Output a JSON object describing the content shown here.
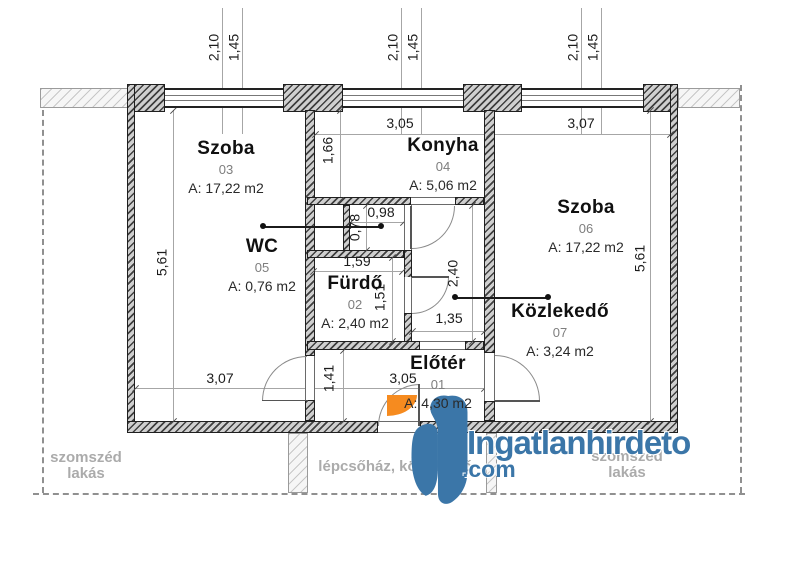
{
  "rooms": {
    "szoba03": {
      "name": "Szoba",
      "num": "03",
      "area": "A: 17,22 m2"
    },
    "konyha": {
      "name": "Konyha",
      "num": "04",
      "area": "A: 5,06 m2"
    },
    "wc": {
      "name": "WC",
      "num": "05",
      "area": "A: 0,76 m2"
    },
    "furdo": {
      "name": "Fürdő",
      "num": "02",
      "area": "A: 2,40 m2"
    },
    "eloter": {
      "name": "Előtér",
      "num": "01",
      "area": "A: 4,30 m2"
    },
    "szoba06": {
      "name": "Szoba",
      "num": "06",
      "area": "A: 17,22 m2"
    },
    "kozlekedo": {
      "name": "Közlekedő",
      "num": "07",
      "area": "A: 3,24 m2"
    }
  },
  "dimensions": {
    "w210": "2,10",
    "w145": "1,45",
    "d305": "3,05",
    "d307": "3,07",
    "d166": "1,66",
    "d561": "5,61",
    "d078": "0,78",
    "d098": "0,98",
    "d159": "1,59",
    "d151": "1,51",
    "d240": "2,40",
    "d135": "1,35",
    "d141": "1,41"
  },
  "labels": {
    "neighbor": "szomszéd lakás",
    "staircase": "lépcsőház, közlekedő"
  },
  "watermark": {
    "brand": "Ingatlanhirdeto",
    "tld": ".com",
    "blue": "#3b76a8",
    "orange": "#f68b1f"
  }
}
